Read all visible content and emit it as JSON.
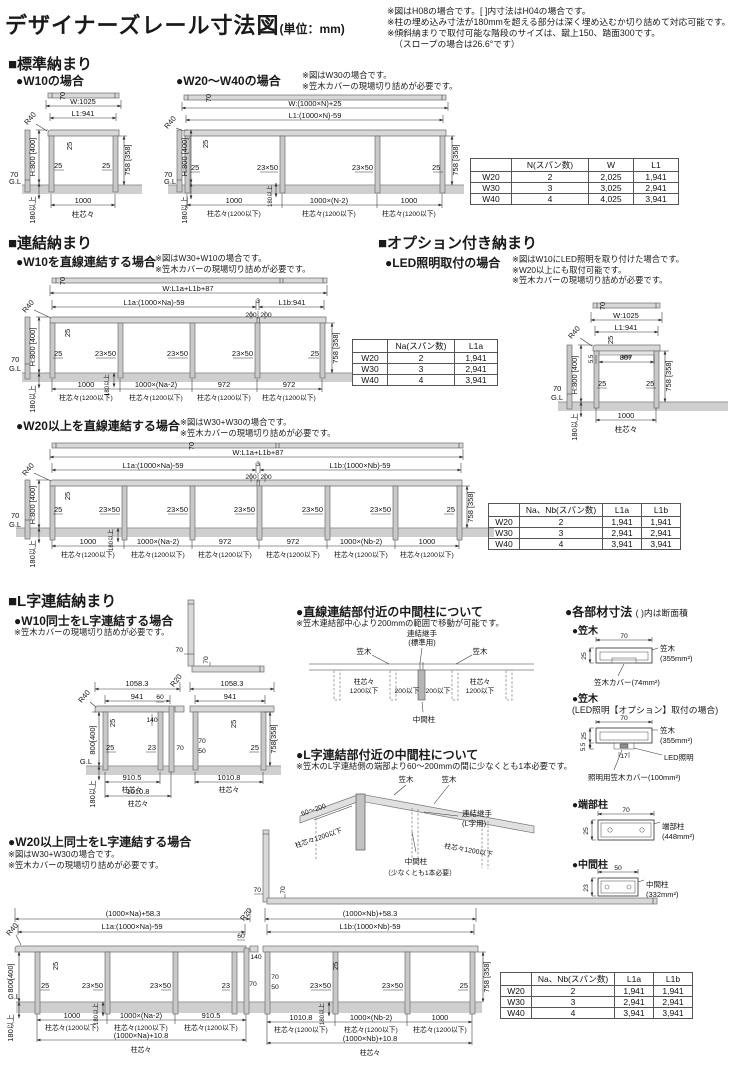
{
  "c": {
    "d25": "25",
    "d70": "70",
    "d50": "50",
    "d23": "23",
    "d60": "60",
    "d140": "140",
    "d200": "200",
    "d3": "3",
    "d17": "17",
    "d55": "5.5",
    "d807": "807",
    "s1000": "1000",
    "gl": "G.L",
    "r40": "R40",
    "r20": "R20",
    "h800": "H:800 [400]",
    "h800s": "800[400]",
    "h758": "758 [358]",
    "h758s": "758[358]",
    "embed": "180以上",
    "mid": "23×50",
    "hashira": "柱芯々",
    "hashira1200": "柱芯々(1200以下)",
    "kasagi": "笠木"
  },
  "header": {
    "title": "デザイナーズレール寸法図",
    "unit": "(単位：mm)",
    "notes": [
      "※図はH08の場合です。[ ]内寸法はH04の場合です。",
      "※柱の埋め込み寸法が180mmを超える部分は深く埋め込むか切り詰めて対応可能です。",
      "※傾斜納まりで取付可能な階段のサイズは、蹴上150、踏面300です。",
      "（スロープの場合は26.6°です）"
    ]
  },
  "sec1": {
    "title": "■標準納まり",
    "w10": {
      "title": "●W10の場合",
      "W": "W:1025",
      "L1": "L1:941"
    },
    "w2040": {
      "title": "●W20～W40の場合",
      "notes": [
        "※図はW30の場合です。",
        "※笠木カバーの現場切り詰めが必要です。"
      ],
      "W": "W:(1000×N)+25",
      "L1": "L1:(1000×N)-59",
      "spans": [
        "1000",
        "1000×(N-2)",
        "1000"
      ]
    },
    "table": {
      "headers": [
        "",
        "N(スパン数)",
        "W",
        "L1"
      ],
      "rows": [
        [
          "W20",
          "2",
          "2,025",
          "1,941"
        ],
        [
          "W30",
          "3",
          "3,025",
          "2,941"
        ],
        [
          "W40",
          "4",
          "4,025",
          "3,941"
        ]
      ]
    }
  },
  "sec2": {
    "title": "■連結納まり",
    "w10c": {
      "title": "●W10を直線連結する場合",
      "notes": [
        "※図はW30+W10の場合です。",
        "※笠木カバーの現場切り詰めが必要です。"
      ],
      "W": "W:L1a+L1b+87",
      "L1a": "L1a:(1000×Na)-59",
      "L1b": "L1b:941",
      "spans": [
        "1000",
        "1000×(Na-2)",
        "972",
        "972"
      ],
      "table": {
        "headers": [
          "",
          "Na(スパン数)",
          "L1a"
        ],
        "rows": [
          [
            "W20",
            "2",
            "1,941"
          ],
          [
            "W30",
            "3",
            "2,941"
          ],
          [
            "W40",
            "4",
            "3,941"
          ]
        ]
      }
    },
    "option": {
      "title": "■オプション付き納まり",
      "led": "●LED照明取付の場合",
      "notes": [
        "※図はW10にLED照明を取り付けた場合です。",
        "※W20以上にも取付可能です。",
        "※笠木カバーの現場切り詰めが必要です。"
      ],
      "W": "W:1025",
      "L1": "L1:941"
    },
    "w20c": {
      "title": "●W20以上を直線連結する場合",
      "notes": [
        "※図はW30+W30の場合です。",
        "※笠木カバーの現場切り詰めが必要です。"
      ],
      "W": "W:L1a+L1b+87",
      "L1a": "L1a:(1000×Na)-59",
      "L1b": "L1b:(1000×Nb)-59",
      "spans": [
        "1000",
        "1000×(Na-2)",
        "972",
        "972",
        "1000×(Nb-2)",
        "1000"
      ]
    }
  },
  "tableL": {
    "headers": [
      "",
      "Na、Nb(スパン数)",
      "L1a",
      "L1b"
    ],
    "rows": [
      [
        "W20",
        "2",
        "1,941",
        "1,941"
      ],
      [
        "W30",
        "3",
        "2,941",
        "2,941"
      ],
      [
        "W40",
        "4",
        "3,941",
        "3,941"
      ]
    ]
  },
  "sec3": {
    "title": "■L字連結納まり",
    "w10L": {
      "title": "●W10同士をL字連結する場合",
      "note": "※笠木カバーの現場切り詰めが必要です。",
      "left": {
        "w": "1058.3",
        "l": "941",
        "s1": "910.5",
        "s2": "1010.8"
      },
      "right": {
        "w": "1058.3",
        "l": "941",
        "s": "1010.8"
      }
    },
    "mid1": {
      "title": "●直線連結部付近の中間柱について",
      "note": "※笠木連結部中心より200mmの範囲で移動が可能です。",
      "joint1": "連結継手",
      "joint2": "(標準用)",
      "h1": "柱芯々",
      "h2": "1200以下",
      "d200": "200以下",
      "chukan": "中間柱"
    },
    "mid2": {
      "title": "●L字連結部付近の中間柱について",
      "note": "※笠木のL字連結側の端部より60～200mmの間に少なくとも1本必要です。",
      "d": "60～200",
      "joint1": "連結継手",
      "joint2": "(L字用)",
      "h": "柱芯々1200以下",
      "chukan": "中間柱",
      "chukan2": "（少なくとも1本必要）"
    },
    "parts": {
      "title": "●各部材寸法",
      "sub": "( )内は断面積",
      "kasagi": {
        "title": "●笠木",
        "label": "笠木",
        "area": "(355mm²)",
        "cover": "笠木カバー(74mm²)"
      },
      "kled": {
        "title": "●笠木",
        "title2": "(LED照明【オプション】取付の場合)",
        "label": "笠木",
        "area": "(355mm²)",
        "led": "LED照明",
        "cover": "照明用笠木カバー(100mm²)"
      },
      "tanbu": {
        "title": "●端部柱",
        "label": "端部柱",
        "area": "(448mm²)"
      },
      "chukan": {
        "title": "●中間柱",
        "label": "中間柱",
        "area": "(332mm²)"
      }
    },
    "w20L": {
      "title": "●W20以上同士をL字連結する場合",
      "notes": [
        "※図はW30+W30の場合です。",
        "※笠木カバーの現場切り詰めが必要です。"
      ],
      "left": {
        "W": "(1000×Na)+58.3",
        "L1a": "L1a:(1000×Na)-59",
        "spans": [
          "1000",
          "1000×(Na-2)",
          "910.5"
        ],
        "total": "(1000×Na)+10.8"
      },
      "right": {
        "W": "(1000×Nb)+58.3",
        "L1b": "L1b:(1000×Nb)-59",
        "spans": [
          "1010.8",
          "1000×(Nb-2)",
          "1000"
        ],
        "total": "(1000×Nb)+10.8"
      }
    }
  }
}
